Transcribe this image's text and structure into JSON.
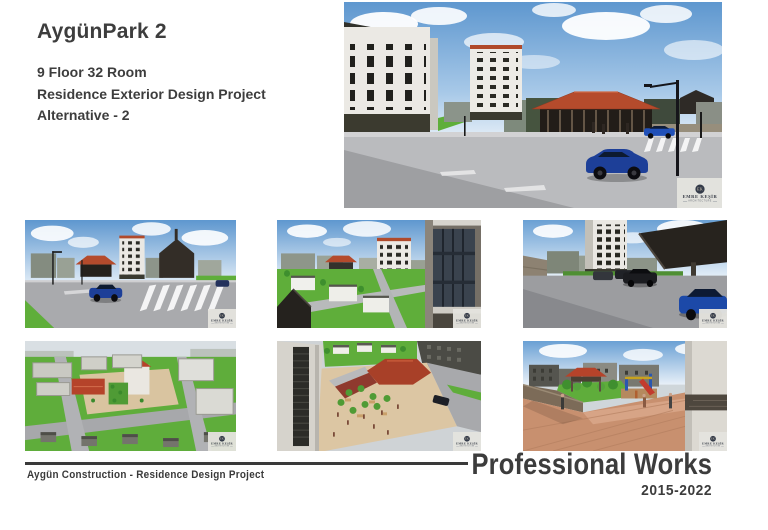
{
  "page": {
    "title": "AygünPark 2",
    "subtitle_lines": [
      "9 Floor 32 Room",
      "Residence Exterior Design Project",
      "Alternative - 2"
    ]
  },
  "watermark": {
    "initials": "EK",
    "name": "EMRE KEŞİR",
    "subtitle": "ARCHITECTURE",
    "icon": "ek-monogram-circle-icon"
  },
  "footer": {
    "left_text": "Aygün Construction - Residence Design Project",
    "right_title": "Professional Works",
    "right_years": "2015-2022"
  },
  "colors": {
    "text_dark": "#3a3a3a",
    "roof_red": "#b5432a",
    "grass_green": "#5fae3a",
    "sky_blue": "#5e97cf",
    "road_gray": "#a9aaad",
    "car_blue": "#1d3f98",
    "plaza_tan": "#d9c4a0"
  }
}
